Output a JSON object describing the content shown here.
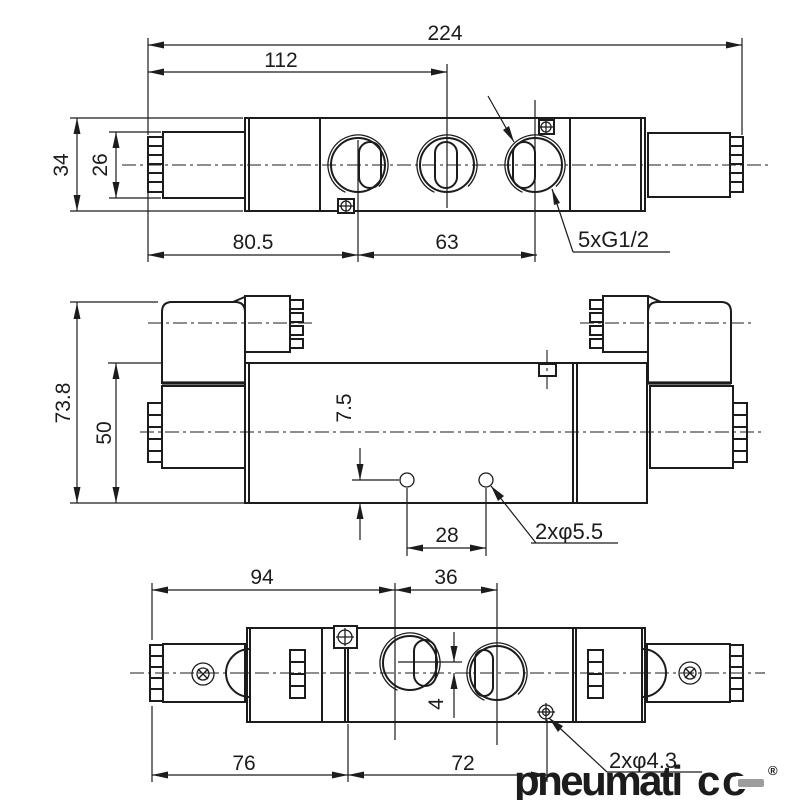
{
  "views": {
    "top": {
      "dim_overall_length": "224",
      "dim_left_to_port2": "112",
      "dim_body_height": "34",
      "dim_end_height": "26",
      "dim_left_to_port1": "80.5",
      "dim_port1_to_port3": "63",
      "label_ports": "5xG1/2"
    },
    "side": {
      "dim_overall_height": "73.8",
      "dim_body_height": "50",
      "dim_hole_to_bottom": "7.5",
      "dim_hole_spacing": "28",
      "label_holes": "2xφ5.5"
    },
    "bottom": {
      "dim_left_to_port_a": "94",
      "dim_port_a_to_b": "36",
      "dim_left_to_body": "76",
      "dim_body_to_hole": "72",
      "dim_port_offset": "4",
      "label_holes": "2xφ4.3"
    }
  },
  "logo": {
    "text_pink": "pneumati",
    "text_gray_c": "c",
    "text_gray_o": "o",
    "registered": "®",
    "pink_hex": "#f49fae",
    "gray_hex": "#9d9d9c"
  },
  "colors": {
    "line_hex": "#1c1c1c",
    "background_hex": "#ffffff"
  }
}
